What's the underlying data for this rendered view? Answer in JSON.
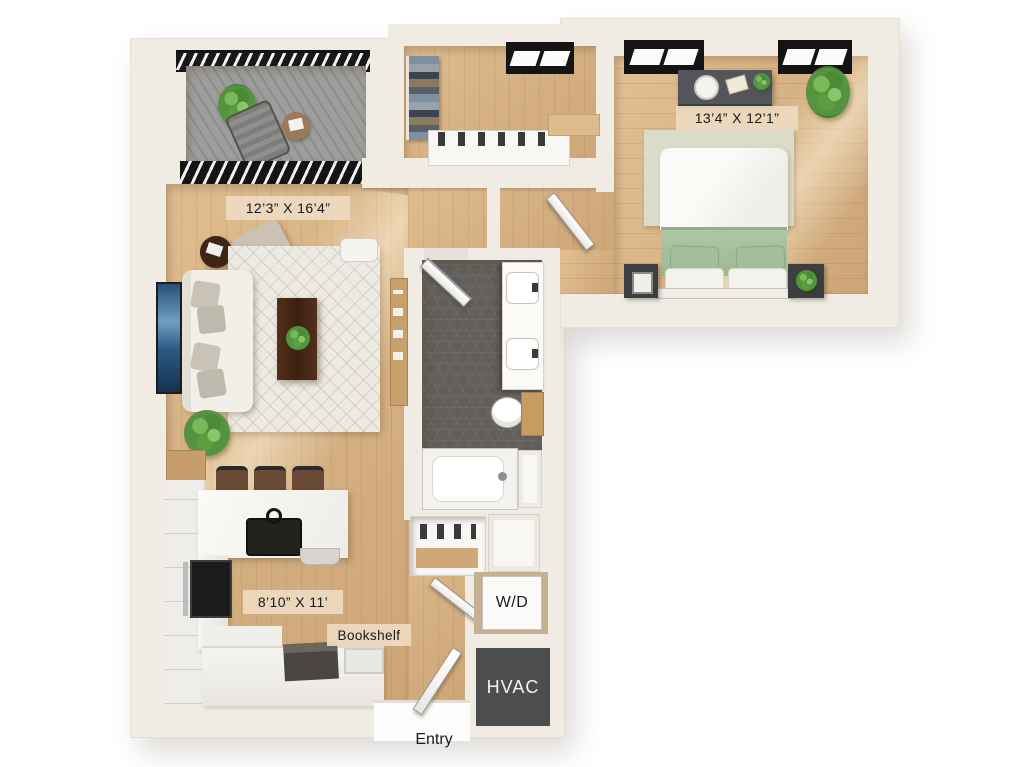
{
  "title": "One-bedroom apartment 3D floor plan",
  "labels": {
    "living_room_dim": "12’3” X 16’4”",
    "bedroom_dim": "13’4” X 12’1”",
    "kitchen_dim": "8’10” X 11’",
    "bookshelf": "Bookshelf",
    "washer_dryer": "W/D",
    "hvac": "HVAC",
    "entry": "Entry"
  },
  "rooms": [
    {
      "name": "living-room",
      "dimensions": "12’3” X 16’4”"
    },
    {
      "name": "bedroom",
      "dimensions": "13’4” X 12’1”"
    },
    {
      "name": "kitchen",
      "dimensions": "8’10” X 11’"
    },
    {
      "name": "bathroom",
      "dimensions": ""
    },
    {
      "name": "walk-in-closet",
      "dimensions": ""
    },
    {
      "name": "balcony",
      "dimensions": ""
    }
  ],
  "palette": {
    "wall": "#f0ebe3",
    "wood_floor": "#d6b183",
    "balcony_concrete": "#9d9d9b",
    "bathroom_tile": "#615e5b",
    "hvac_box": "#4b4d4f",
    "label_background": "#eed9c1",
    "bed_green": "#a9c2a0",
    "plant_green": "#569340"
  }
}
